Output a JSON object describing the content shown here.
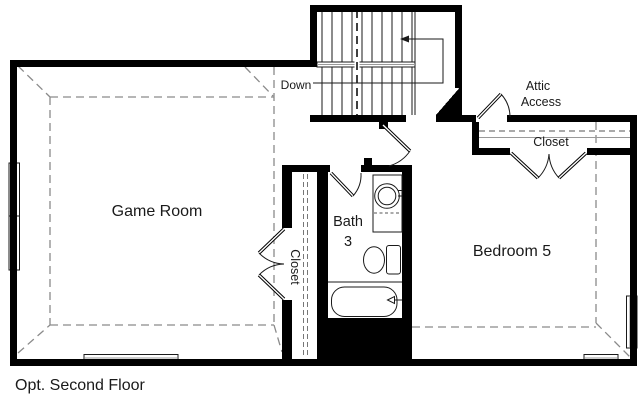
{
  "title": "Opt. Second Floor",
  "colors": {
    "wall": "#000000",
    "line": "#1a1a1a",
    "ceiling_dash": "#8a8a8a",
    "background": "#ffffff"
  },
  "labels": {
    "game_room": "Game Room",
    "bath_line1": "Bath",
    "bath_line2": "3",
    "bedroom": "Bedroom 5",
    "closet_game_room": "Closet",
    "closet_bedroom": "Closet",
    "attic_line1": "Attic",
    "attic_line2": "Access",
    "stairs_direction": "Down",
    "caption": "Opt. Second Floor"
  },
  "rooms": [
    "Game Room",
    "Bath 3",
    "Bedroom 5",
    "Closet",
    "Closet",
    "Attic Access",
    "Stairs"
  ],
  "fixtures": [
    "bathtub",
    "toilet",
    "sink-vanity",
    "staircase",
    "windows",
    "attic-access-door"
  ]
}
